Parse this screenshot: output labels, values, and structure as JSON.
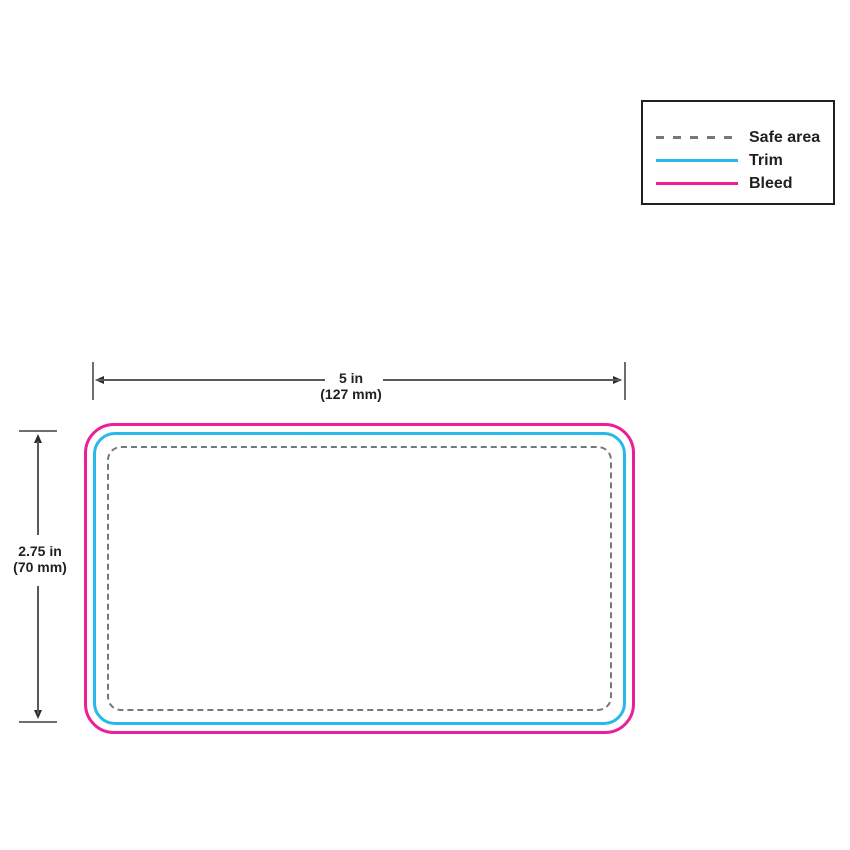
{
  "legend": {
    "items": [
      {
        "label": "Safe area",
        "line_style": "dashed",
        "color": "#76777A"
      },
      {
        "label": "Trim",
        "line_style": "solid",
        "color": "#29B8EB"
      },
      {
        "label": "Bleed",
        "line_style": "solid",
        "color": "#EC1E98"
      }
    ]
  },
  "dimensions": {
    "width": {
      "value": "5 in",
      "metric": "(127 mm)"
    },
    "height": {
      "value": "2.75 in",
      "metric": "(70 mm)"
    }
  },
  "card": {
    "bleed_color": "#EC1E98",
    "trim_color": "#29B8EB",
    "safe_area_color": "#76777A",
    "corner_style": "rounded"
  },
  "annotation_colors": {
    "dimension_line": "#58595B",
    "arrowhead": "#2B2B2C",
    "text": "#231F20"
  }
}
